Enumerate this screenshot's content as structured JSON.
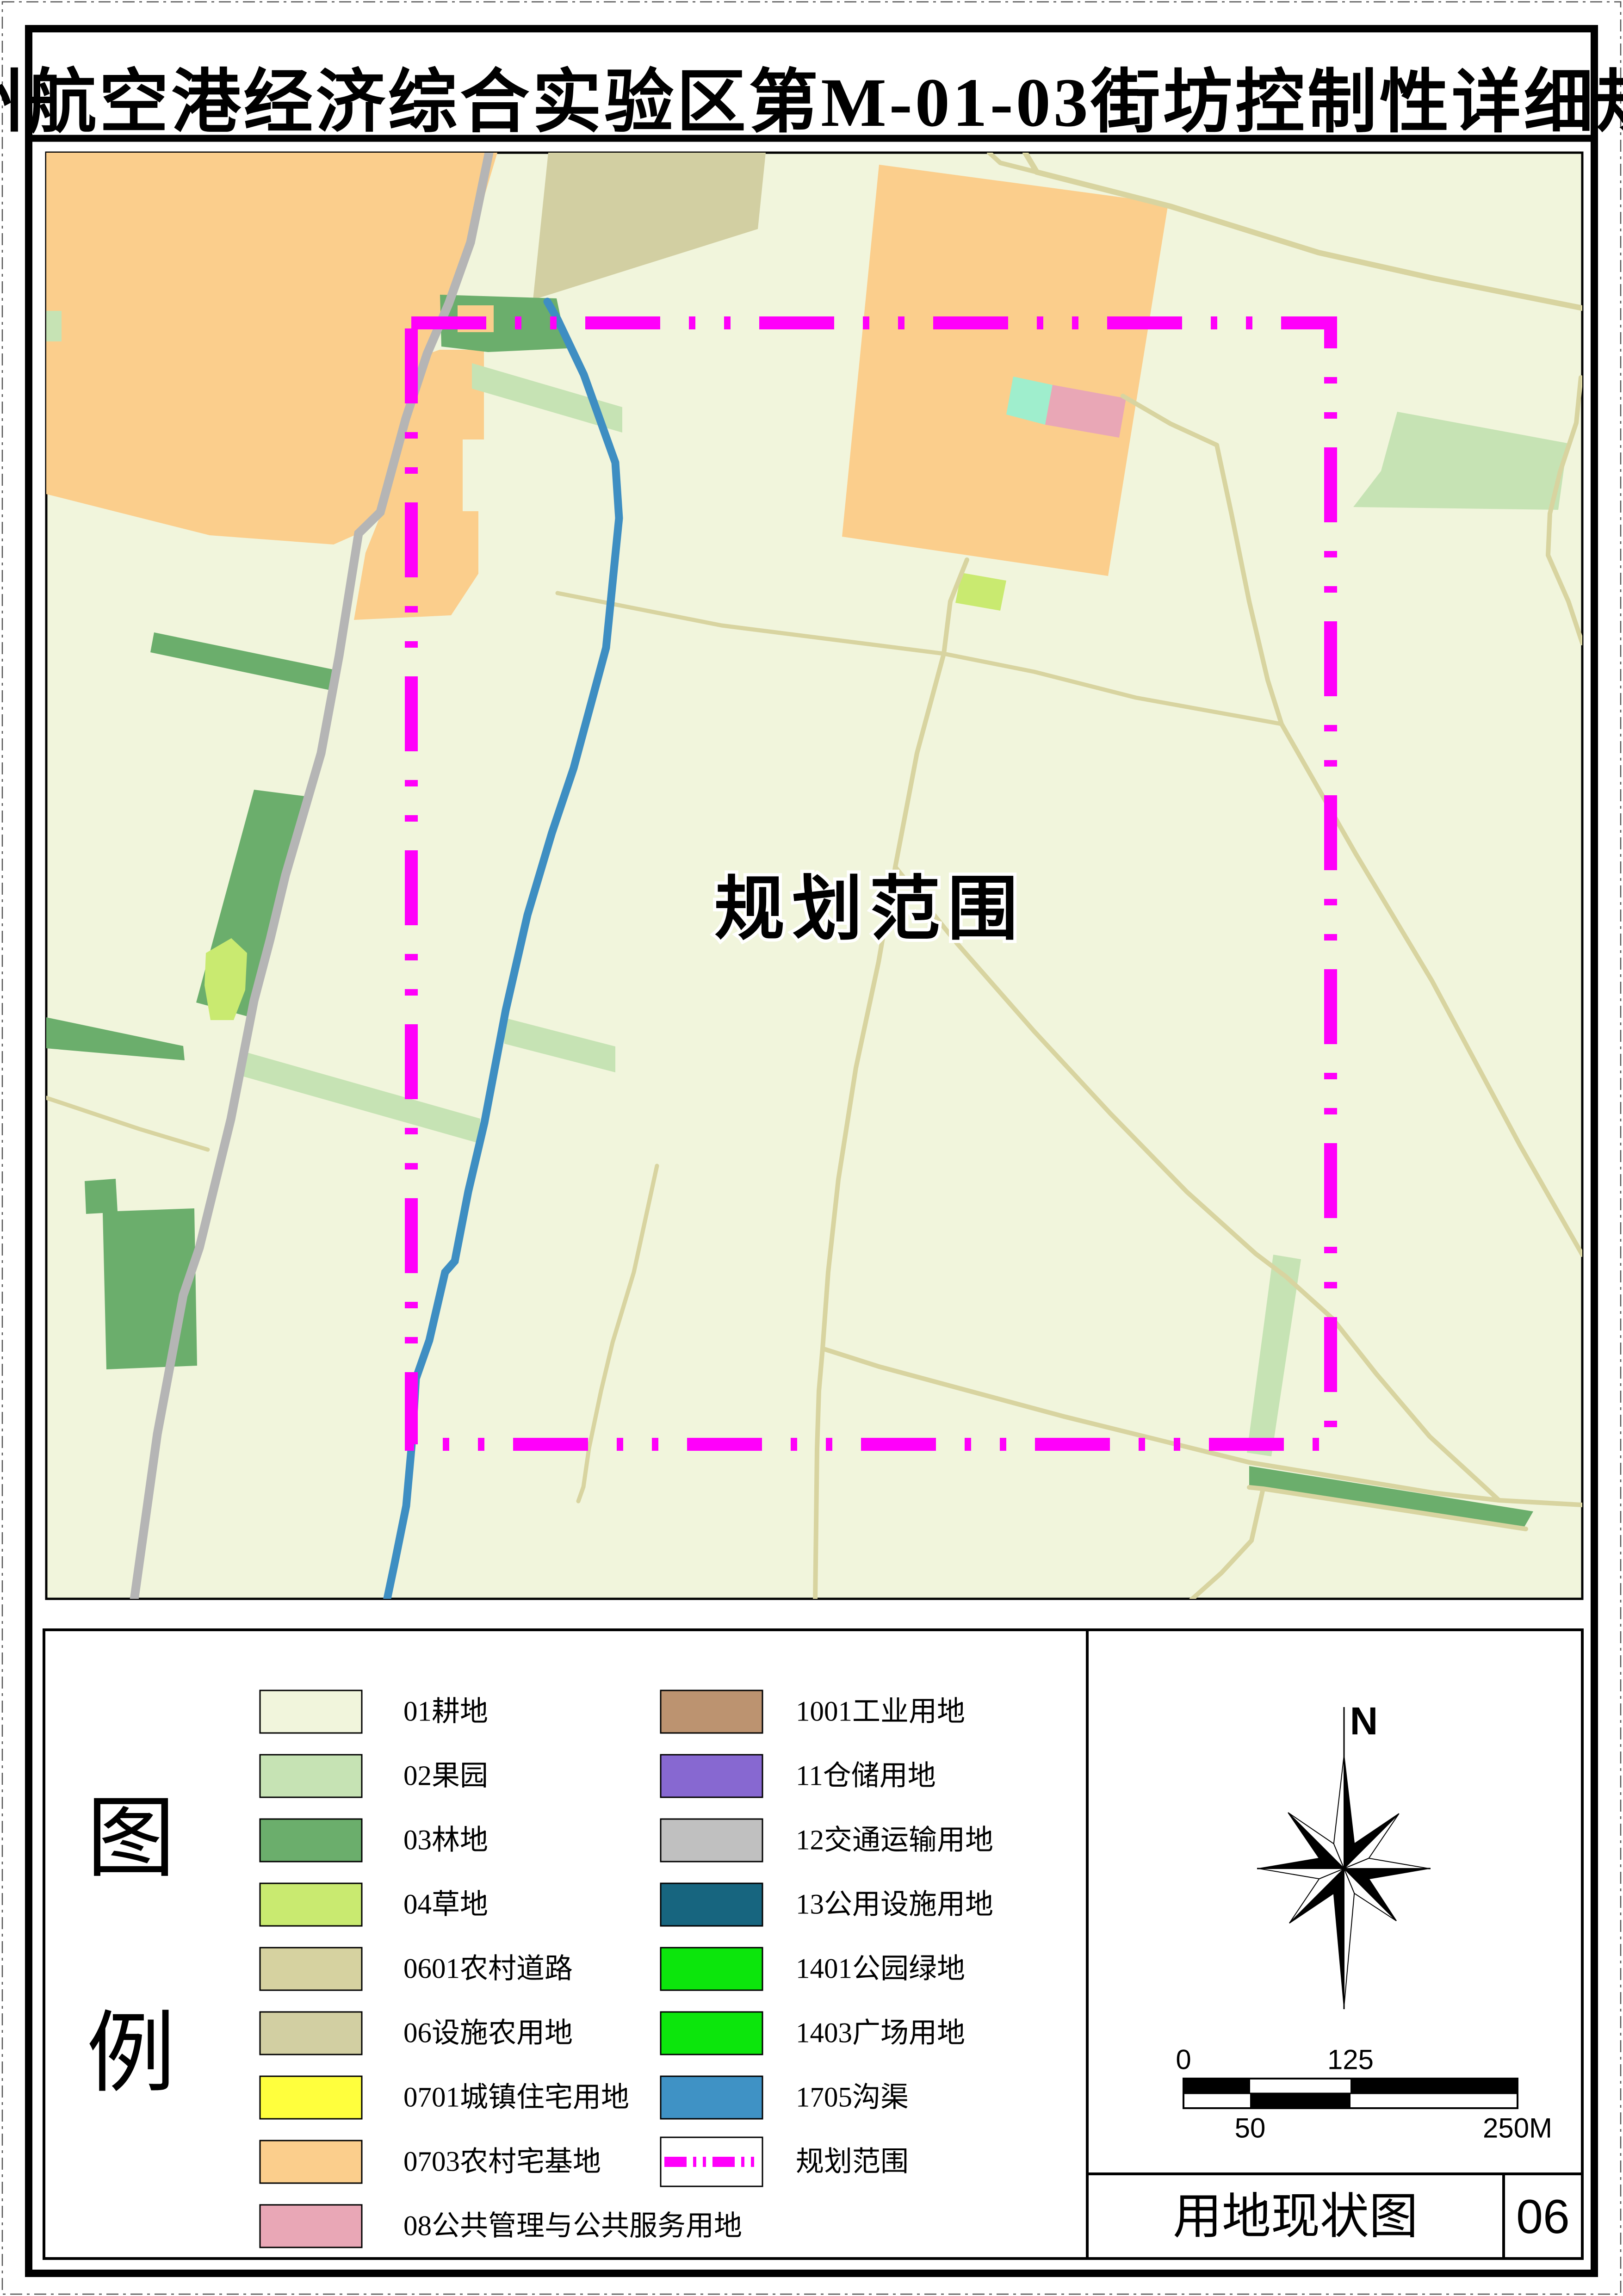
{
  "title": "郑州航空港经济综合实验区第M-01-03街坊控制性详细规划",
  "map": {
    "scope_label": "规划范围"
  },
  "legend": {
    "heading_top": "图",
    "heading_bottom": "例",
    "left": [
      {
        "label": "01耕地"
      },
      {
        "label": "02果园"
      },
      {
        "label": "03林地"
      },
      {
        "label": "04草地"
      },
      {
        "label": "0601农村道路"
      },
      {
        "label": "06设施农用地"
      },
      {
        "label": "0701城镇住宅用地"
      },
      {
        "label": "0703农村宅基地"
      },
      {
        "label": "08公共管理与公共服务用地"
      }
    ],
    "right": [
      {
        "label": "1001工业用地"
      },
      {
        "label": "11仓储用地"
      },
      {
        "label": "12交通运输用地"
      },
      {
        "label": "13公用设施用地"
      },
      {
        "label": "1401公园绿地"
      },
      {
        "label": "1403广场用地"
      },
      {
        "label": "1705沟渠"
      },
      {
        "label": "规划范围"
      }
    ]
  },
  "compass": {
    "north_label": "N"
  },
  "scale_bar": {
    "tick_0": "0",
    "tick_125": "125",
    "tick_50": "50",
    "tick_250": "250M"
  },
  "title_block": {
    "drawing_name": "用地现状图",
    "sheet_number": "06"
  },
  "colors": {
    "c01": "#F1F5DC",
    "c02": "#C6E3B4",
    "c03": "#6BAE6C",
    "c04": "#C9EA70",
    "c0601": "#D6D2A0",
    "c06": "#D2CFA2",
    "c0701": "#FFFF3D",
    "c0703": "#FBCE8C",
    "c08": "#E9A7B6",
    "c1001": "#BC9370",
    "c11": "#8768D1",
    "c12": "#C0C0C0",
    "c13": "#17657F",
    "c1401": "#0CE60C",
    "c1403": "#0CE60C",
    "c1705": "#3F92C5",
    "road_gray": "#B5B5B5",
    "path_tan": "#D8D4A0",
    "canal_blue": "#3E8EC2",
    "boundary_magenta": "#FF00FA",
    "scope_text_blue": "#2727D9"
  }
}
